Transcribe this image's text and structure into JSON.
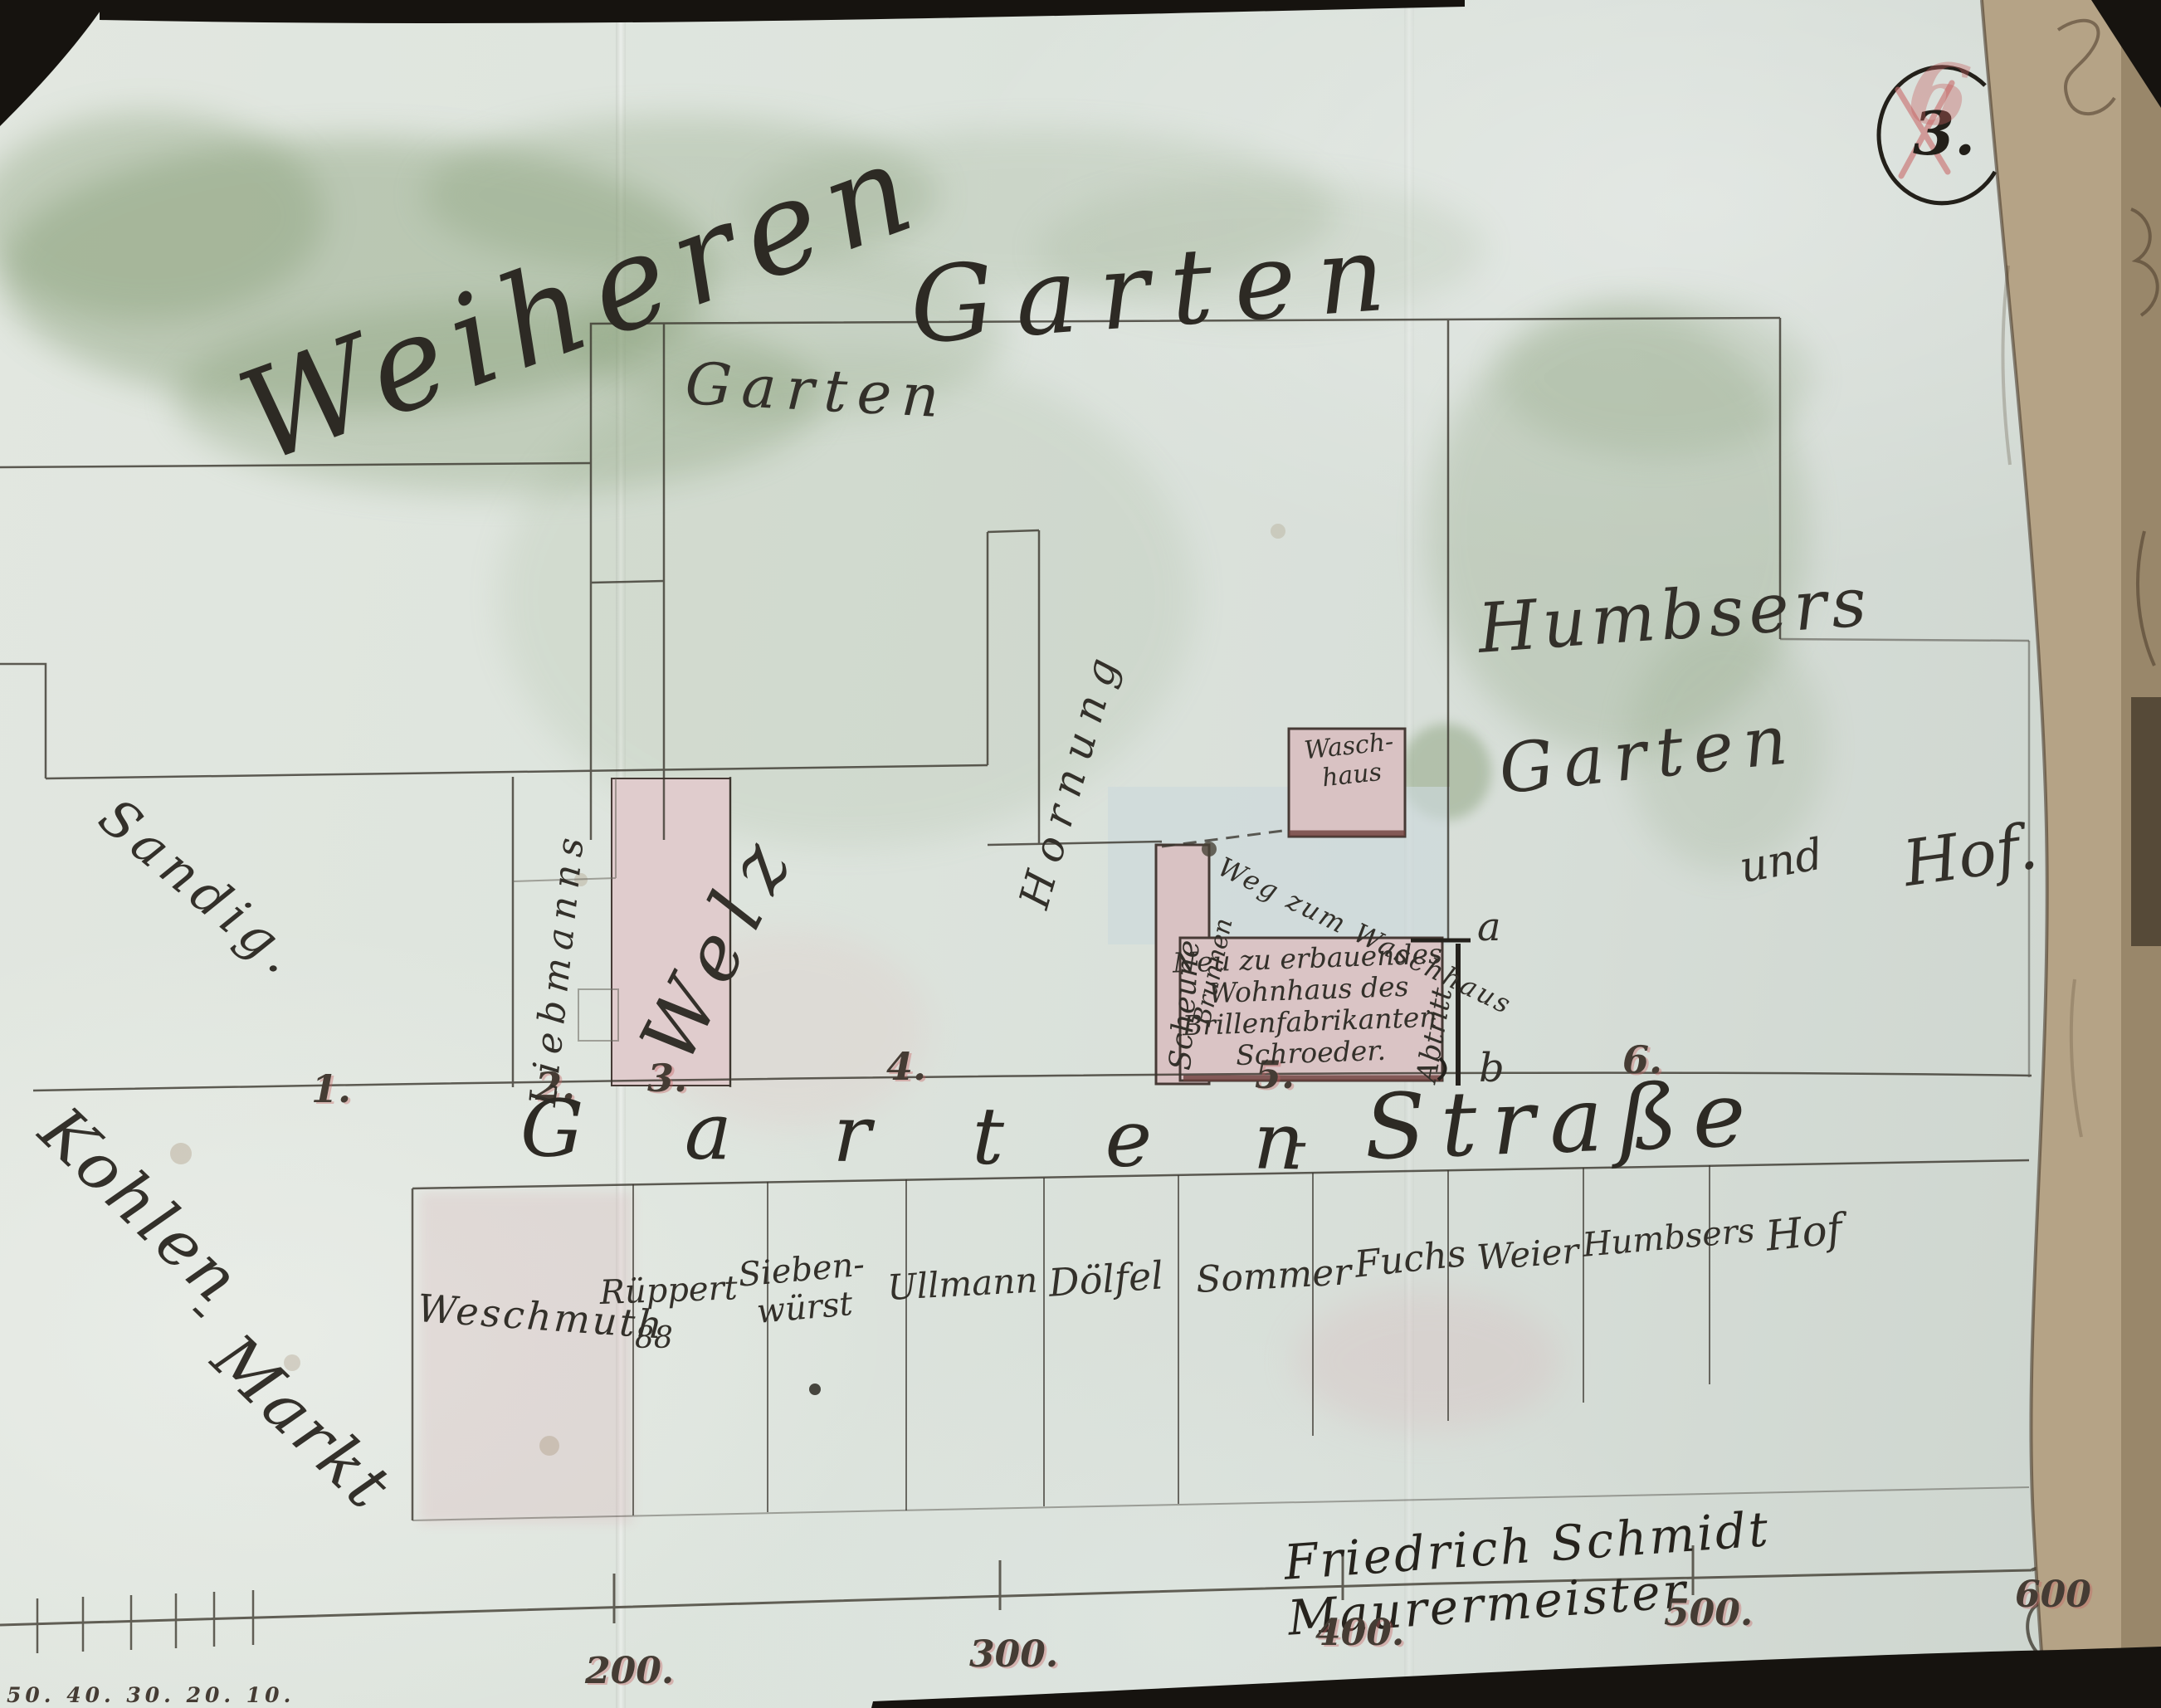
{
  "document": {
    "page_number": "3.",
    "red_number": "6",
    "signature": "Friedrich Schmidt Maurermeister"
  },
  "areas": {
    "big_label_word1": "Weiheren",
    "big_label_word2": "Garten",
    "garden_small": "Garten",
    "humbser_line1": "Humbsers",
    "humbser_line2": "Garten",
    "humbser_line3": "und",
    "humbser_line4": "Hof.",
    "left_field": "Sandig.",
    "market_word1": "Kohlen",
    "market_dash": "-",
    "market_word2": "Markt"
  },
  "features": {
    "alley_owner": "Hornung",
    "parcel2_owner": "Liebmanns",
    "parcel3_owner": "Welz",
    "barn": "Scheune",
    "well": "Brunnen",
    "path": "Weg zum Waschhaus",
    "privy": "Abtritt",
    "washhouse": "Wasch-\nhaus",
    "main_building": "Neu zu erbauendes\nWohnhaus des\nBrillenfabrikanten\nSchroeder.",
    "point_a": "a",
    "point_b": "b"
  },
  "parcel_numbers": [
    "1.",
    "2.",
    "3.",
    "4.",
    "5.",
    "6."
  ],
  "street": {
    "part1": "G a r t e n",
    "dash": "-",
    "part2": "Straße"
  },
  "south_row": {
    "parcels": [
      {
        "name": "Weschmuth"
      },
      {
        "name": "Rüppert",
        "house_number": "88"
      },
      {
        "name": "Sieben-\nwürst"
      },
      {
        "name": "Ullmann"
      },
      {
        "name": "Dölfel"
      },
      {
        "name": "Sommer"
      },
      {
        "name": "Fuchs"
      },
      {
        "name": "Weier"
      },
      {
        "name": "Humbsers"
      },
      {
        "name": "Hof"
      }
    ]
  },
  "scale": {
    "major_ticks": [
      "200.",
      "300.",
      "400.",
      "500.",
      "600"
    ],
    "minor_ticks": "50. 40. 30. 20. 10."
  },
  "colors": {
    "paper": "#dde4dd",
    "ink": "#38342c",
    "building_pink": "#d9c2c3",
    "wash_green": "#7e976d",
    "accent_red": "#c05f5f",
    "page_edge_tan": "#b5a386"
  }
}
